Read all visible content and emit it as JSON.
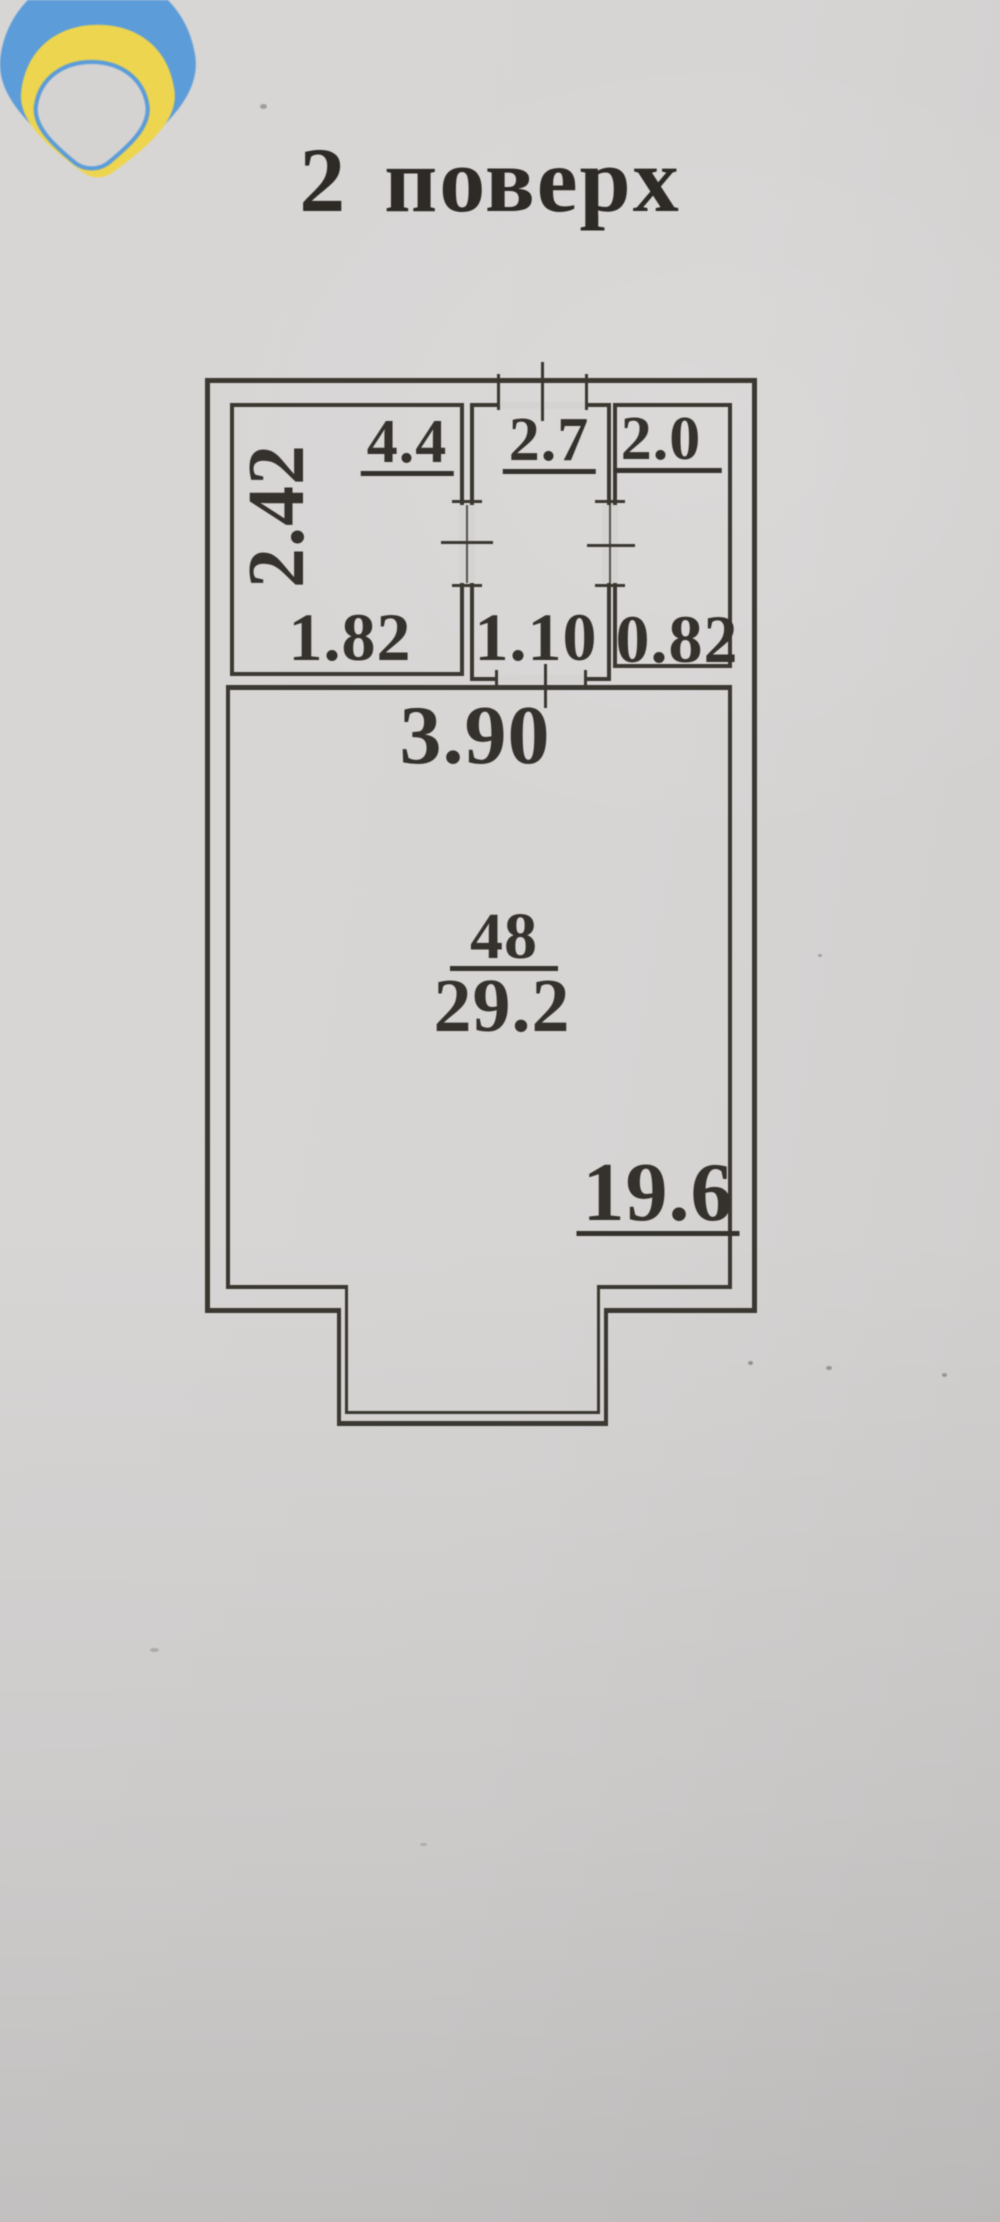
{
  "title": "2 поверх",
  "colors": {
    "paper": "#d5d3d2",
    "ink": "#35312c",
    "line": "#3b3731",
    "logo-blue": "#5b9cd9",
    "logo-yellow": "#eed54f"
  },
  "plan": {
    "room1": {
      "area": "4.4",
      "height_dim": "2.42",
      "width_dim": "1.82"
    },
    "room2": {
      "area": "2.7",
      "width_dim": "1.10"
    },
    "room3": {
      "area": "2.0",
      "width_dim": "0.82"
    },
    "main_room": {
      "width_dim": "3.90",
      "number": "48",
      "area": "29.2",
      "lower_area": "19.6"
    }
  }
}
